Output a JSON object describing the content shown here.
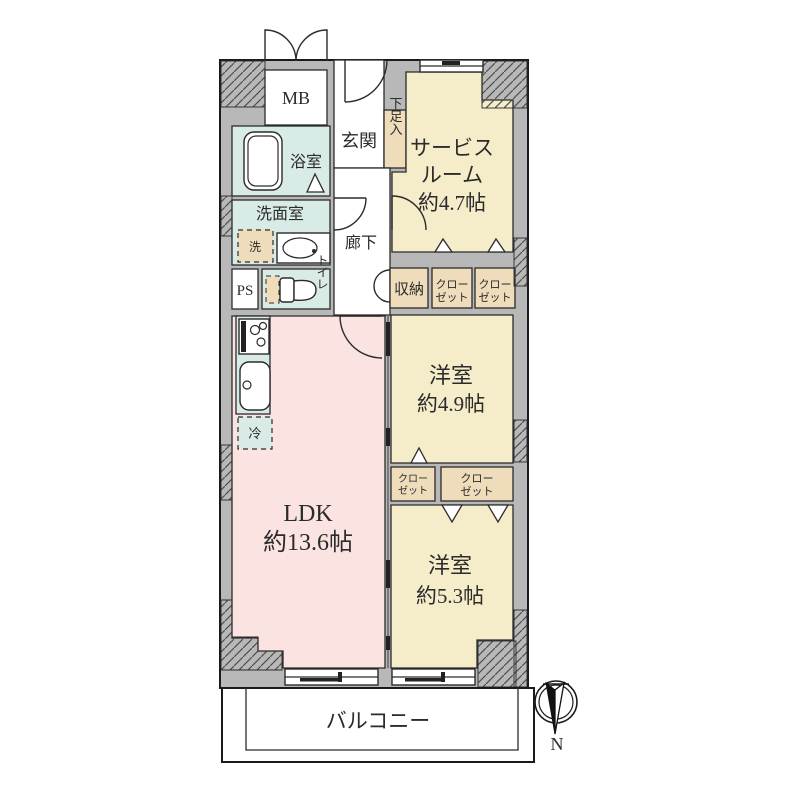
{
  "plan": {
    "mb": "MB",
    "entrance": "玄関",
    "shoe_cabinet": "下足入",
    "service_room_1": "サービス",
    "service_room_2": "ルーム",
    "service_room_3": "約4.7帖",
    "bathroom": "浴室",
    "washroom": "洗面室",
    "washer": "洗",
    "corridor": "廊下",
    "pipe_space": "PS",
    "toilet": "トイレ",
    "storage": "収納",
    "closet_1": "クロー",
    "closet_2": "ゼット",
    "bedroom1_1": "洋室",
    "bedroom1_2": "約4.9帖",
    "bedroom2_1": "洋室",
    "bedroom2_2": "約5.3帖",
    "ldk_1": "LDK",
    "ldk_2": "約13.6帖",
    "fridge": "冷",
    "balcony": "バルコニー",
    "north": "N"
  },
  "colors": {
    "wall": "#b8b8b8",
    "room_cream": "#f5ecca",
    "closet_tan": "#efdcba",
    "ldk_pink": "#fbe3e1",
    "wet_teal": "#d8ebe6",
    "outline": "#222222"
  }
}
